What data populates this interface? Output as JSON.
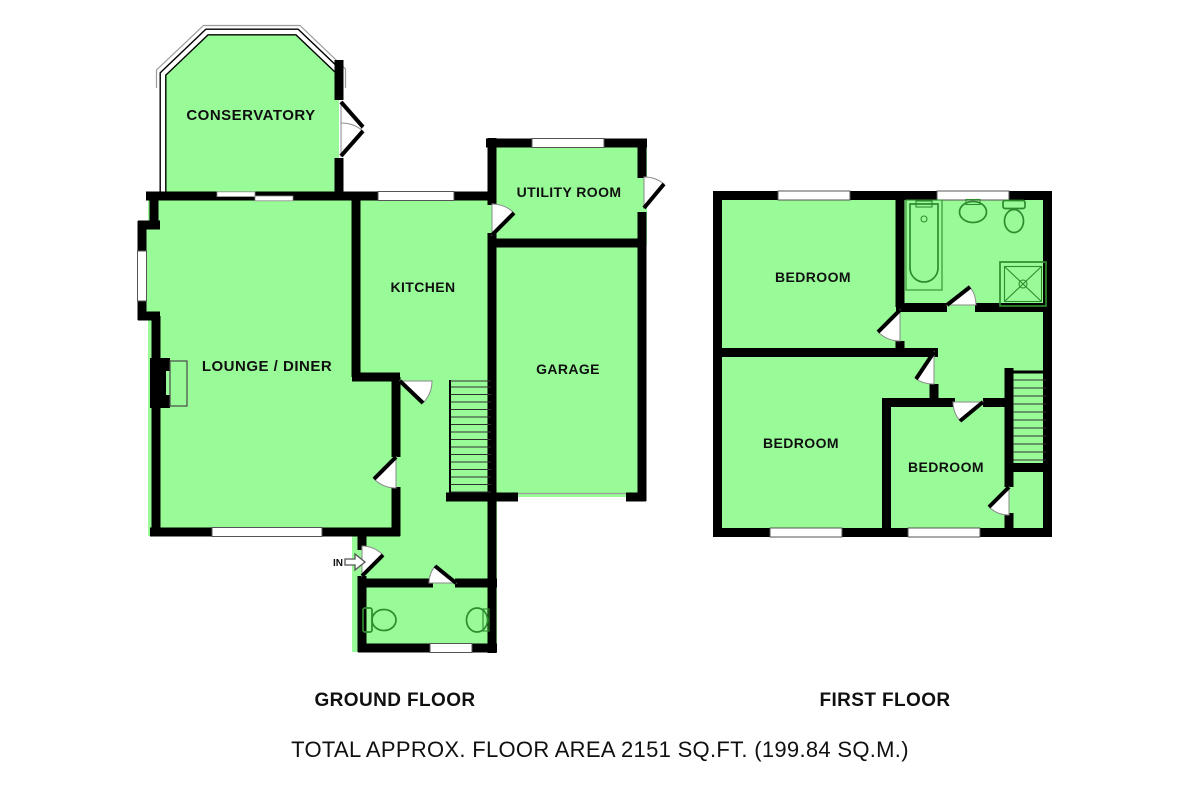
{
  "floorplan": {
    "ground_floor": {
      "title": "GROUND FLOOR",
      "rooms": {
        "conservatory": "CONSERVATORY",
        "utility_room": "UTILITY ROOM",
        "kitchen": "KITCHEN",
        "lounge_diner": "LOUNGE / DINER",
        "garage": "GARAGE"
      },
      "entrance_label": "IN"
    },
    "first_floor": {
      "title": "FIRST FLOOR",
      "rooms": {
        "bedroom_top": "BEDROOM",
        "bedroom_bottom_left": "BEDROOM",
        "bedroom_bottom_right": "BEDROOM"
      }
    },
    "total_area_label": "TOTAL APPROX. FLOOR AREA 2151 SQ.FT. (199.84 SQ.M.)",
    "colors": {
      "room_fill": "#98fb98",
      "wall": "#000000",
      "fixture_outline": "#2e8b2e",
      "window_fill": "#ffffff",
      "background": "#ffffff",
      "text": "#101010"
    }
  }
}
